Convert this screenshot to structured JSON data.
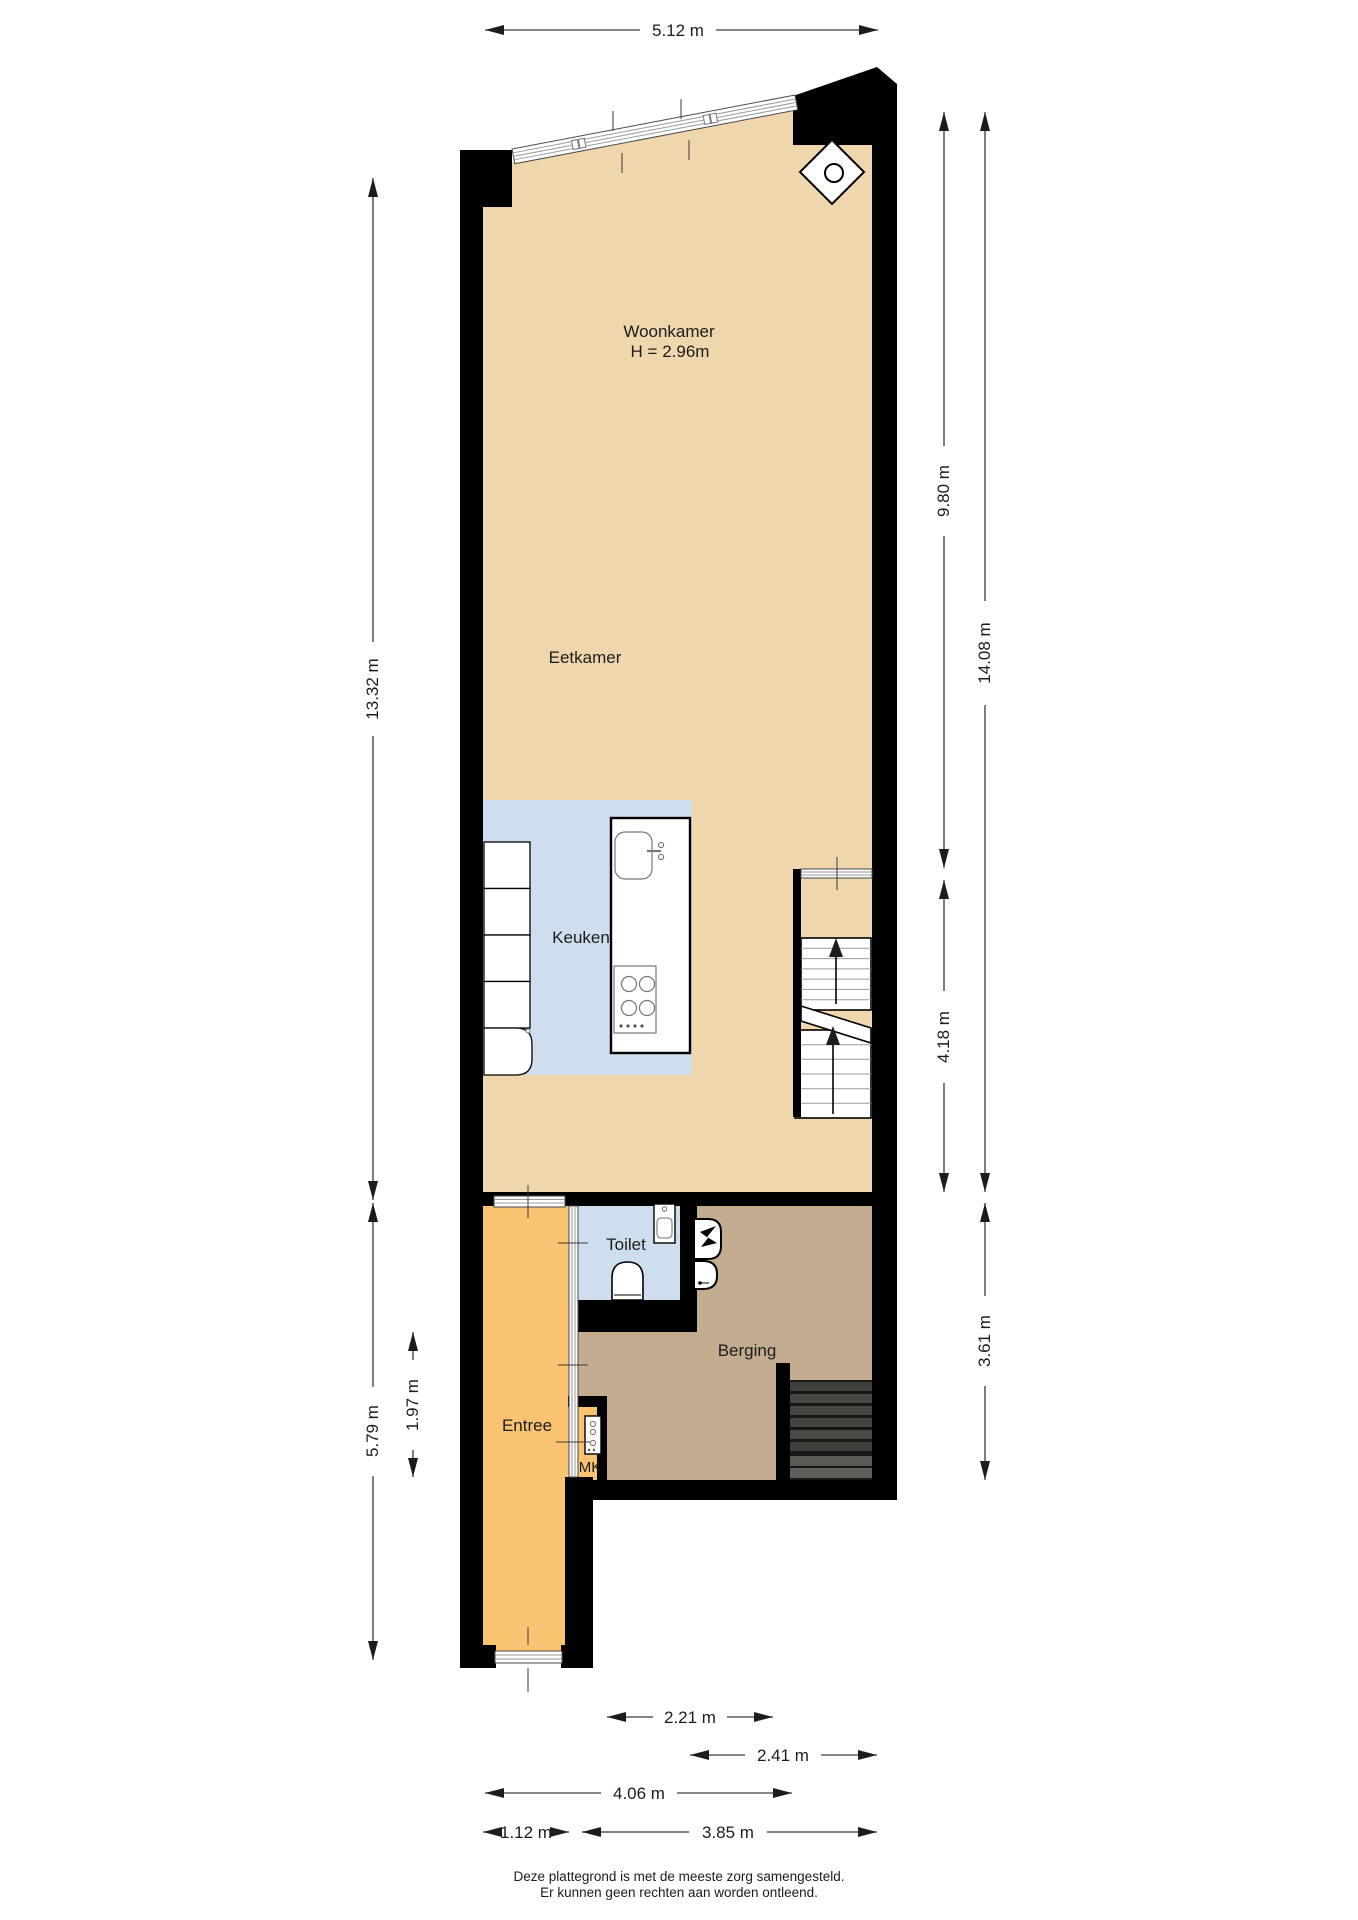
{
  "plan": {
    "type": "floorplan",
    "rooms": {
      "woonkamer": {
        "label": "Woonkamer",
        "height_note": "H = 2.96m"
      },
      "eetkamer": {
        "label": "Eetkamer"
      },
      "keuken": {
        "label": "Keuken"
      },
      "toilet": {
        "label": "Toilet"
      },
      "berging": {
        "label": "Berging"
      },
      "entree": {
        "label": "Entree"
      },
      "meterkast": {
        "label": "MK"
      }
    },
    "dimensions": {
      "top_width": "5.12 m",
      "left_main_height": "13.32 m",
      "left_lower_height": "5.79 m",
      "entree_inner_height": "1.97 m",
      "right_upper_height": "9.80 m",
      "right_stair_height": "4.18 m",
      "right_total_height": "14.08 m",
      "right_lower_height": "3.61 m",
      "bottom_toilet_width": "2.21 m",
      "bottom_berging_width": "2.41 m",
      "bottom_upper_width": "4.06 m",
      "bottom_entree_width": "1.12 m",
      "bottom_lower_width": "3.85 m"
    },
    "colors": {
      "wall": "#000000",
      "floor_main": "#efd6ad",
      "floor_kitchen": "#cfdeee",
      "floor_entree": "#f9c372",
      "floor_berging": "#c3ac90"
    },
    "footer": {
      "line1": "Deze plattegrond is met de meeste zorg samengesteld.",
      "line2": "Er kunnen geen rechten aan worden ontleend."
    }
  }
}
